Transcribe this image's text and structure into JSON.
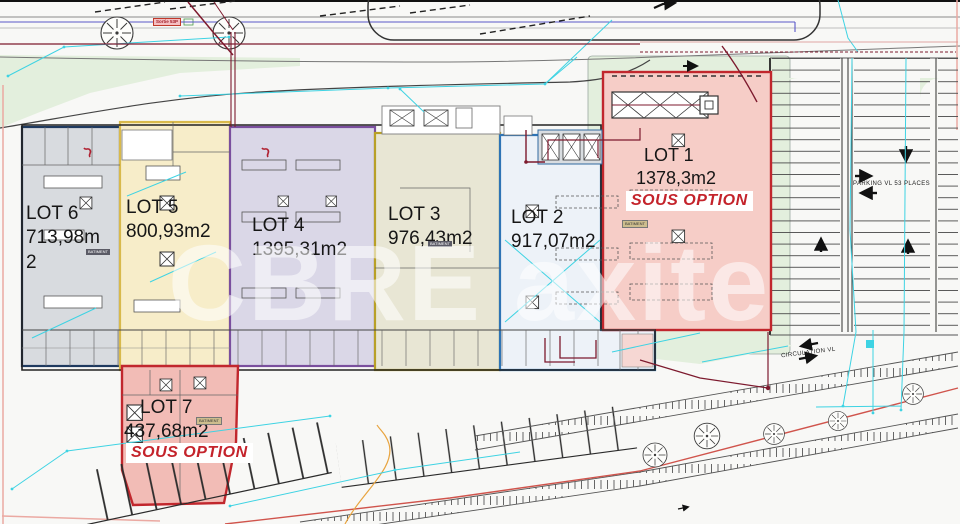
{
  "plan": {
    "watermark": "CBRE axite",
    "lots": [
      {
        "name": "LOT 1",
        "area": "1378,3m2",
        "option": "SOUS OPTION"
      },
      {
        "name": "LOT 2",
        "area": "917,07m2"
      },
      {
        "name": "LOT 3",
        "area": "976,43m2"
      },
      {
        "name": "LOT 4",
        "area": "1395,31m2"
      },
      {
        "name": "LOT 5",
        "area": "800,93m2"
      },
      {
        "name": "LOT 6",
        "area": "713,98m2"
      },
      {
        "name": "LOT 7",
        "area": "437,68m2",
        "option": "SOUS OPTION"
      }
    ],
    "labels": {
      "parking": "PARKING VL 53 PLACES",
      "circulation": "CIRCULATION VL",
      "exit_box": "Sortie 53P",
      "batiment_badge": "BATIMENT"
    },
    "colors": {
      "lot1_fill": "#f6cdc7",
      "lot1_border": "#c1272d",
      "lot2_fill": "#edf2f8",
      "lot2_border": "#2e74b5",
      "lot3_fill": "#e8e6d4",
      "lot3_border": "#b8a027",
      "lot4_fill": "#dad7e7",
      "lot4_border": "#7a4f9e",
      "lot5_fill": "#f7edc9",
      "lot5_border": "#d8b94c",
      "lot6_fill": "#d8dbdf",
      "lot6_border": "#1f3a5f",
      "lot7_fill": "#f2bcb6",
      "lot7_border": "#c1272d",
      "option_text": "#c4232b",
      "green_area": "#e3efdd",
      "measure_cyan": "#3ed3e3",
      "fire_maroon": "#7d1a2e",
      "boundary_red_line": "#d0544c"
    }
  }
}
